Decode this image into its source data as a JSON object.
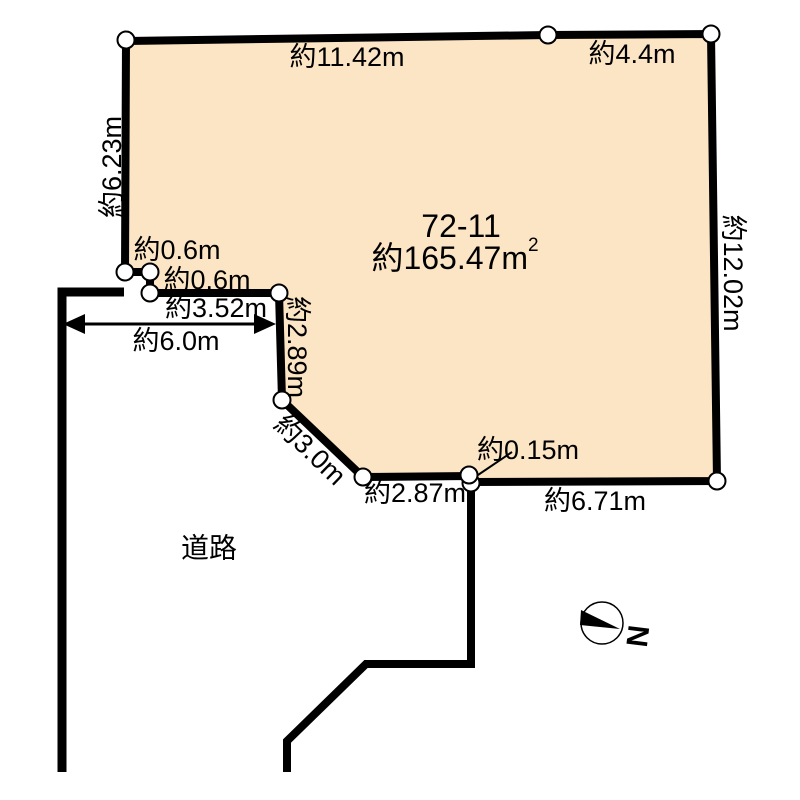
{
  "diagram": {
    "parcel": {
      "lot_number": "72-11",
      "area": "約165.47m",
      "area_sup": "2",
      "edges": {
        "top_left": "約11.42m",
        "top_right": "約4.4m",
        "left": "約6.23m",
        "right": "約12.02m",
        "bottom": "約6.71m",
        "bottom_jog": "約0.15m",
        "bottom_left": "約2.87m",
        "diagonal": "約3.0m",
        "notch_vertical": "約2.89m",
        "notch_horizontal": "約3.52m",
        "notch_step_upper": "約0.6m",
        "notch_step_lower": "約0.6m"
      }
    },
    "road": {
      "name": "道路",
      "width": "約6.0m"
    },
    "compass": {
      "north": "N"
    },
    "colors": {
      "parcel_fill": "#FCE5C4",
      "line": "#000000",
      "marker_fill": "#FFFFFF"
    }
  }
}
